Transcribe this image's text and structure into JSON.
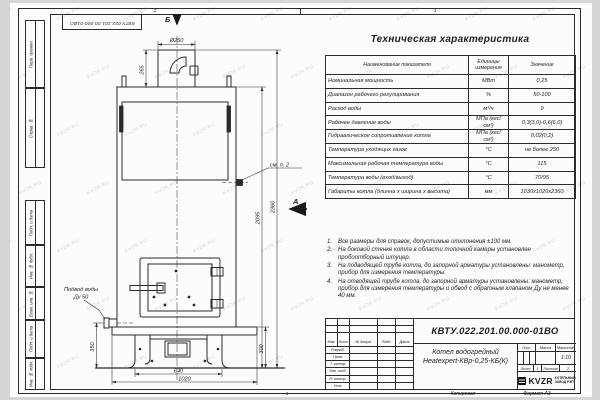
{
  "frame": {
    "inv_title": "КВТУ.022.201.00.000-01ВО",
    "zone_top_left": "2",
    "zone_top_right": "1",
    "zone_bottom": "1",
    "side_labels": [
      "Перв. примен.",
      "Справ. №",
      "Подп. и дата",
      "Инв. № дубл.",
      "Взам. инв. №",
      "Подп. и дата",
      "Инв. № подл."
    ],
    "copy_label": "Копировал",
    "format_label": "Формат А3"
  },
  "watermark": {
    "text": "KVZR.RU"
  },
  "drawing": {
    "section_mark": "Б",
    "view_mark": "А",
    "see_note": "см. п. 2",
    "inlet_label_line1": "Подвод воды",
    "inlet_label_line2": "Ду 50",
    "dims": {
      "chimney_dia": "Ø250",
      "chimney_height": "265",
      "total_height": "2360",
      "body_height": "2095",
      "inlet_height": "350",
      "base_height": "300",
      "support_width": "640",
      "base_width": "1020"
    }
  },
  "spec_table": {
    "title": "Техническая характеристика",
    "headers": [
      "Наименование показателя",
      "Единицы измерения",
      "Значение"
    ],
    "rows": [
      {
        "name": "Номинальная мощность",
        "units": "МВт",
        "value": "0,25"
      },
      {
        "name": "Диапазон рабочего регулирования",
        "units": "%",
        "value": "50-100"
      },
      {
        "name": "Расход воды",
        "units": "м³/ч",
        "value": "9"
      },
      {
        "name": "Рабочее давление воды",
        "units": "МПа (кгс/см²)",
        "value": "0,3(3,0)-0,6(6,0)"
      },
      {
        "name": "Гидравлическое сопротивление котла",
        "units": "МПа (кгс/см²)",
        "value": "0,02(0,2)"
      },
      {
        "name": "Температура уходящих газов",
        "units": "°С",
        "value": "не более 250"
      },
      {
        "name": "Максимальная рабочая температура воды",
        "units": "°С",
        "value": "115"
      },
      {
        "name": "Температура воды (вход/выход)",
        "units": "°С",
        "value": "70/95"
      },
      {
        "name": "Габариты котла (длинна х ширина х высота)",
        "units": "мм",
        "value": "1030х1020х2360"
      }
    ]
  },
  "notes": {
    "items": [
      {
        "num": "1.",
        "text": "Все размеры для справок, допустимые отклонения ±100 мм."
      },
      {
        "num": "2.",
        "text": "На боковой стенке котла в области топочной камеры установлен пробоотборный штуцер."
      },
      {
        "num": "3.",
        "text": "На подводящей трубе котла, до запорной арматуры установлены: манометр, прибор для измерения температуры."
      },
      {
        "num": "4.",
        "text": "На отводящей трубе котла, до запорной арматуры установлены: манометр, прибор для измерения температуры и обвод с обратным клапаном Ду не менее 40 мм."
      }
    ]
  },
  "title_block": {
    "doc_number": "КВТУ.022.201.00.000-01ВО",
    "product_line1": "Котел водогрейный",
    "product_line2": "Heatexpert-КВр-0,25-КБ(К)",
    "header_cols": [
      "Изм.",
      "Лист",
      "№ докум.",
      "Подп.",
      "Дата"
    ],
    "role_rows": [
      "Разраб.",
      "Пров.",
      "Т. контр.",
      "Нач. отд.",
      "Н. контр.",
      "Утв."
    ],
    "lit_label": "Лит.",
    "mass_label": "Масса",
    "scale_label": "Масштаб",
    "scale_value": "1:10",
    "sheet_label": "Лист",
    "sheet_value": "1",
    "sheets_label": "Листов",
    "sheets_value": "2",
    "company": {
      "logo": "KVZR",
      "line1": "КОТЕЛЬНЫЙ",
      "line2": "ЗАВОД РЭП"
    }
  },
  "colors": {
    "line": "#2b2b2b",
    "sheet": "#fcfcfc",
    "background": "#d6d6d6",
    "watermark": "#8fa3ad"
  }
}
